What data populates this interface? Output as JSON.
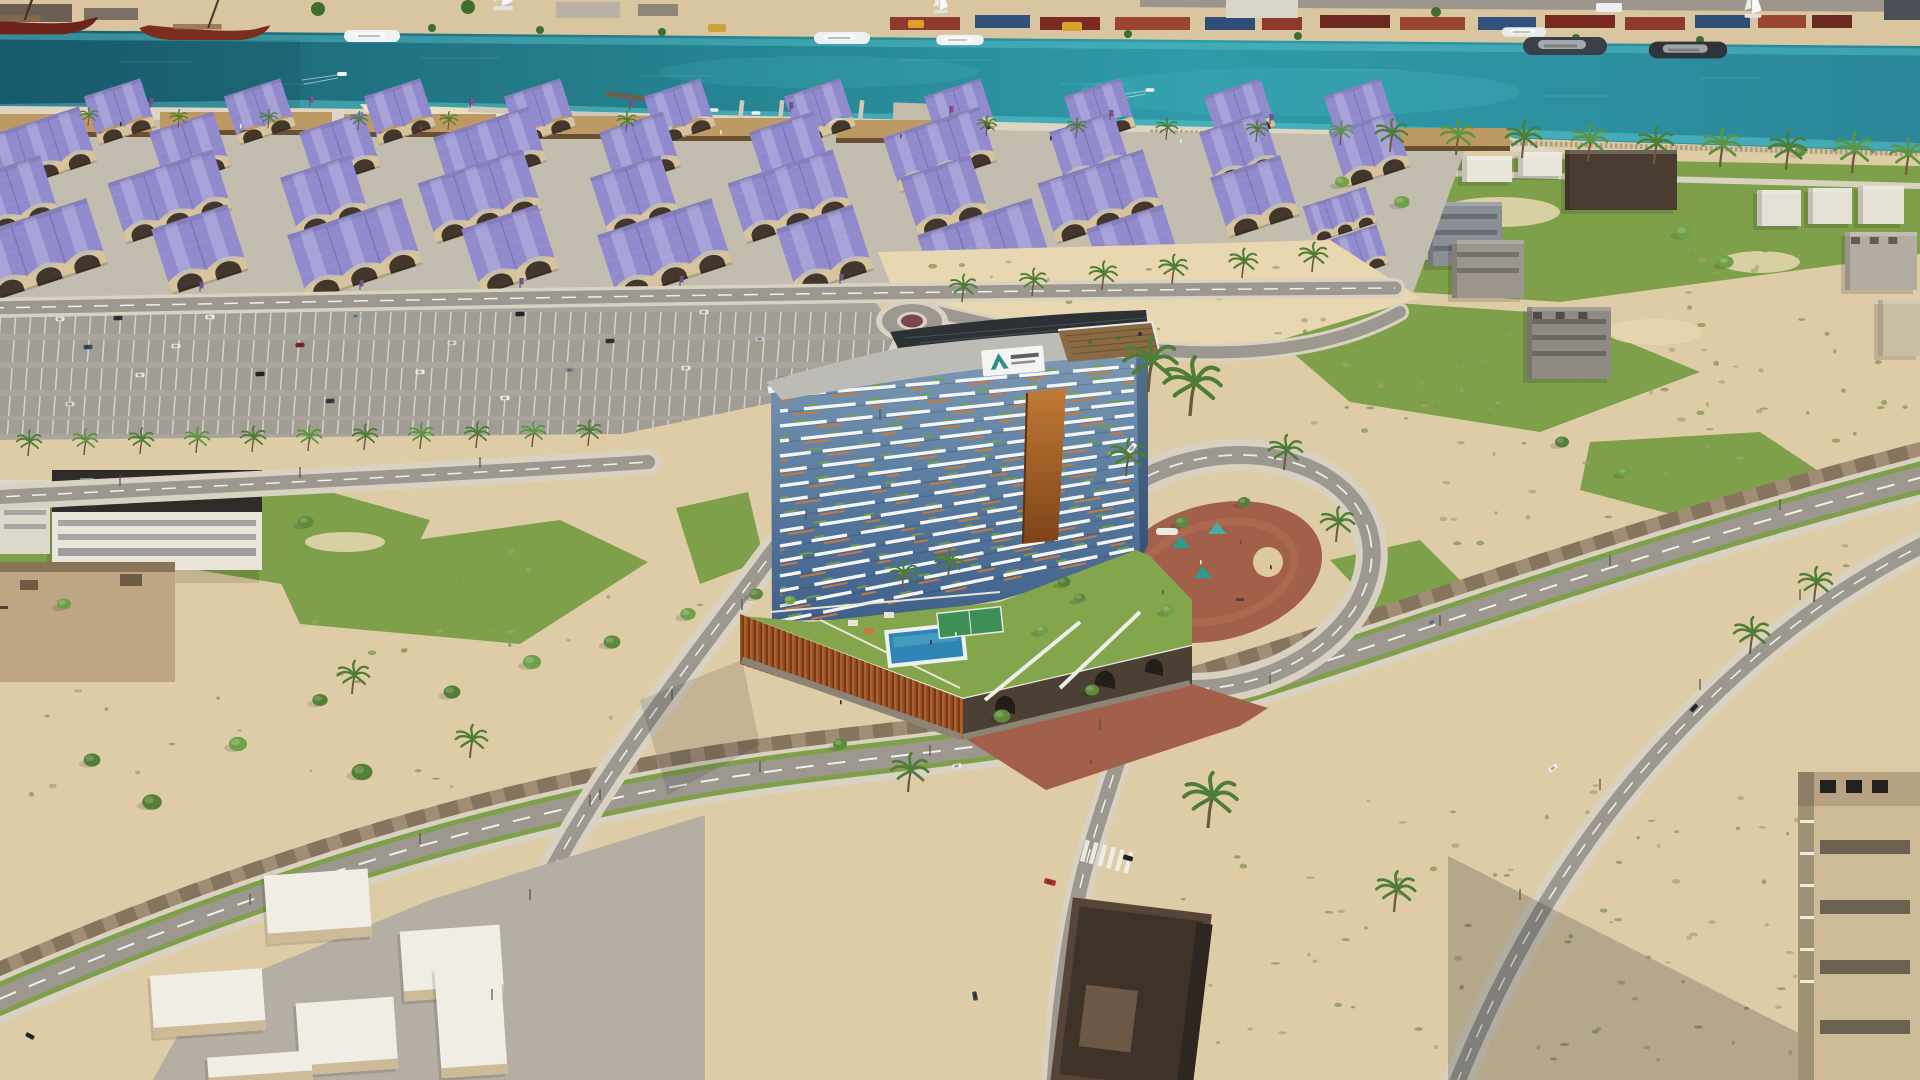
{
  "meta": {
    "title": "Aerial 3D rendering of a curved waterfront residential tower with podium pool deck, purple barrel-vault warehouse souk district, marina quay with yachts, parking lots, loop road plaza and desert infill lots",
    "image_type": "architectural visualization photograph (no UI elements)",
    "resolution": "1920x1080"
  },
  "palette": {
    "sand": "#decca6",
    "sand_light": "#e8d7b1",
    "quay": "#d9c6a0",
    "prom": "#ddd5c2",
    "lane": "#c3bdb0",
    "water_deep": "#1a5f70",
    "water_mid": "#27828f",
    "water_bright": "#2f9aa8",
    "water_shallow": "#5ec9cf",
    "grass": "#7fa04b",
    "deck_lawn": "#83a54c",
    "parking": "#a9a59d",
    "road": "#9c9890",
    "sidewalk": "#d9d2c2",
    "paver": "#a18c76",
    "brick": "#a2604a",
    "whroof": "#918bcd",
    "whwall": "#d8c49c",
    "wharch": "#43362c",
    "canopy": "#bd9a64",
    "stone": "#8c8476",
    "pool": "#2f86b5",
    "court": "#3d8f55",
    "podium_orange": "#b05e2c",
    "podium_orange_dark": "#7a3c1c",
    "podium_face_dark": "#4c4034",
    "glass_top": "#7d9ab5",
    "glass_mid": "#5d7fa2",
    "glass_bottom": "#3f608a",
    "balcony_white": "#f4f5f6",
    "accent_orange": "#c9793a",
    "plant_green": "#74a043",
    "roof_gray": "#bdbbb6",
    "pv_dark": "#2c3136",
    "pergola": "#8a6a44",
    "logo_teal": "#2a8f86",
    "tree": "#5d8a3c",
    "palm": "#4e7d35",
    "boat_red": "#6e241a",
    "yacht_dark": "#3a4047",
    "shadow": "rgba(20,25,30,0.22)"
  },
  "sign": {
    "shape": "white fascia billboard on tower crown",
    "mark": "teal triangular A emblem",
    "text": "dark wordmark, illegible at this resolution",
    "mark_color": "#2a8f86"
  },
  "tower": {
    "floors": 16,
    "x_left": 780,
    "x_right": 1134,
    "y_first_left": 396,
    "step_left": 15.0,
    "y_first_right": 366,
    "step_right": 12.2,
    "white_dashes": [
      "46 12 58 10 34 16 52 12 40 14",
      "30 16 52 10 62 12 36 14 48 10",
      "56 10 36 14 44 16 58 10 30 12",
      "40 12 62 10 30 18 54 10 44 12"
    ],
    "offsets": [
      0,
      22,
      9,
      31,
      15,
      3,
      27,
      12,
      20,
      6,
      34,
      17,
      25,
      11,
      29,
      8
    ],
    "orange_dash": "18 40 26 52 14 44 22 38",
    "green_dash": "8 46 14 38 10 52 12 42"
  },
  "warehouses": {
    "rows": [
      {
        "y": 112,
        "s": 0.74,
        "n2": true,
        "xs": [
          120,
          260,
          400,
          540,
          680,
          820,
          960,
          1100,
          1240,
          1360
        ]
      },
      {
        "y": 150,
        "s": 0.84,
        "xs": [
          40,
          190,
          340,
          490,
          640,
          790,
          940,
          1090,
          1240,
          1370
        ],
        "ns": [
          3,
          2,
          2,
          3,
          2,
          2,
          3,
          2,
          2,
          2
        ]
      },
      {
        "y": 197,
        "s": 0.92,
        "xs": [
          15,
          170,
          325,
          480,
          635,
          790,
          945,
          1100,
          1255
        ],
        "ns": [
          2,
          3,
          2,
          3,
          2,
          3,
          2,
          3,
          2
        ]
      },
      {
        "y": 250,
        "s": 1.0,
        "xs": [
          40,
          200,
          355,
          510,
          665,
          825,
          985,
          1135
        ],
        "ns": [
          3,
          2,
          3,
          2,
          3,
          2,
          3,
          2
        ]
      }
    ],
    "extras": [
      {
        "x": 1340,
        "y": 215,
        "s": 0.55,
        "n": 3
      },
      {
        "x": 1360,
        "y": 252,
        "s": 0.6,
        "n": 2
      }
    ]
  },
  "canopies": [
    [
      0,
      114,
      152
    ],
    [
      160,
      112,
      172
    ],
    [
      344,
      114,
      152
    ],
    [
      506,
      116,
      158
    ],
    [
      672,
      118,
      148
    ],
    [
      836,
      120,
      132
    ],
    [
      1392,
      128,
      118
    ]
  ],
  "containers": [
    [
      890,
      70,
      "#8f3a2c"
    ],
    [
      975,
      55,
      "#31517c"
    ],
    [
      1040,
      60,
      "#7a2a22"
    ],
    [
      1115,
      75,
      "#9a4532"
    ],
    [
      1205,
      50,
      "#2e4e78"
    ],
    [
      1262,
      40,
      "#8f3a2c"
    ],
    [
      1320,
      70,
      "#6b2a20"
    ],
    [
      1400,
      65,
      "#9a4532"
    ],
    [
      1478,
      58,
      "#31517c"
    ],
    [
      1545,
      70,
      "#7a2a22"
    ],
    [
      1625,
      60,
      "#8f3a2c"
    ],
    [
      1695,
      55,
      "#2e4e78"
    ],
    [
      1758,
      48,
      "#9a4532"
    ],
    [
      1812,
      40,
      "#6b2a20"
    ]
  ],
  "quay_buildings": [
    [
      0,
      4,
      72,
      18,
      "#6b5f54"
    ],
    [
      84,
      8,
      54,
      12,
      "#7d7166"
    ],
    [
      556,
      2,
      64,
      16,
      "#b9b2a4"
    ],
    [
      638,
      4,
      40,
      12,
      "#8f8776"
    ],
    [
      1226,
      0,
      72,
      18,
      "#d9d5c9"
    ],
    [
      1884,
      0,
      36,
      20,
      "#4a4f55"
    ]
  ],
  "trucks": [
    [
      1062,
      22,
      20,
      9,
      "#d9a22a"
    ],
    [
      708,
      24,
      18,
      8,
      "#caa23a"
    ],
    [
      908,
      20,
      16,
      8,
      "#d9a22a"
    ],
    [
      1596,
      3,
      26,
      9,
      "#eceef0"
    ]
  ],
  "quay_trees": [
    [
      150,
      30,
      4
    ],
    [
      318,
      9,
      7
    ],
    [
      468,
      7,
      7
    ],
    [
      432,
      28,
      4
    ],
    [
      540,
      30,
      4
    ],
    [
      662,
      32,
      4
    ],
    [
      1128,
      34,
      4
    ],
    [
      1298,
      36,
      4
    ],
    [
      1436,
      12,
      5
    ],
    [
      1576,
      38,
      4
    ],
    [
      1700,
      40,
      4
    ]
  ],
  "boats": [
    {
      "t": "dhow",
      "x": 15,
      "y": 20,
      "s": 1.6,
      "c": "#6e241a"
    },
    {
      "t": "dhow",
      "x": 200,
      "y": 28,
      "s": 1.35,
      "c": "#7c2e1e"
    },
    {
      "t": "yacht",
      "x": 372,
      "y": 36,
      "s": 1.0,
      "c": "#f1f2f3"
    },
    {
      "t": "yacht",
      "x": 842,
      "y": 38,
      "s": 1.0,
      "c": "#eef0f1"
    },
    {
      "t": "yacht",
      "x": 960,
      "y": 40,
      "s": 0.85,
      "c": "#f1f2f3"
    },
    {
      "t": "yacht",
      "x": 1524,
      "y": 32,
      "s": 0.8,
      "c": "#e8eaec"
    },
    {
      "t": "yacht",
      "x": 1565,
      "y": 46,
      "s": 1.5,
      "c": "#3a4047"
    },
    {
      "t": "yacht",
      "x": 1688,
      "y": 50,
      "s": 1.4,
      "c": "#2e343a"
    },
    {
      "t": "sail",
      "x": 502,
      "y": 6,
      "s": 1.1
    },
    {
      "t": "sail",
      "x": 940,
      "y": 10,
      "s": 0.8
    },
    {
      "t": "sail",
      "x": 1752,
      "y": 14,
      "s": 0.95
    },
    {
      "t": "skiff",
      "x": 342,
      "y": 74,
      "s": 1.0
    },
    {
      "t": "skiff",
      "x": 1150,
      "y": 90,
      "s": 0.9
    },
    {
      "t": "skiff",
      "x": 698,
      "y": 104,
      "s": 1.4
    },
    {
      "t": "skiff",
      "x": 714,
      "y": 110,
      "s": 0.9
    },
    {
      "t": "skiff",
      "x": 756,
      "y": 113,
      "s": 0.9
    },
    {
      "t": "skiff",
      "x": 800,
      "y": 111,
      "s": 0.9
    },
    {
      "t": "skiff",
      "x": 905,
      "y": 117,
      "s": 0.9
    },
    {
      "t": "skiff",
      "x": 933,
      "y": 119,
      "s": 0.9
    }
  ],
  "wave_lines": [
    [
      120,
      62,
      70
    ],
    [
      260,
      84,
      60
    ],
    [
      420,
      58,
      80
    ],
    [
      640,
      76,
      70
    ],
    [
      900,
      60,
      90
    ],
    [
      1060,
      84,
      70
    ],
    [
      1320,
      70,
      80
    ],
    [
      1540,
      96,
      70
    ],
    [
      1700,
      78,
      60
    ],
    [
      380,
      98,
      50
    ]
  ],
  "buildings_right": [
    {
      "x": 1300,
      "y": 142,
      "w": 46,
      "h": 56,
      "c": "#c4ad89",
      "ac": true
    },
    {
      "x": 1565,
      "y": 150,
      "w": 112,
      "h": 60,
      "c": "#4a3c30"
    },
    {
      "x": 1462,
      "y": 156,
      "w": 50,
      "h": 26,
      "c": "#e9e5db"
    },
    {
      "x": 1518,
      "y": 152,
      "w": 44,
      "h": 24,
      "c": "#e9e5db"
    },
    {
      "x": 1428,
      "y": 202,
      "w": 74,
      "h": 64,
      "c": "#8a8f96",
      "win": true
    },
    {
      "x": 1452,
      "y": 240,
      "w": 72,
      "h": 58,
      "c": "#9b958b",
      "win": true
    },
    {
      "x": 1527,
      "y": 307,
      "w": 84,
      "h": 72,
      "c": "#8f8a82",
      "ac": true,
      "win": true
    },
    {
      "x": 1757,
      "y": 190,
      "w": 44,
      "h": 36,
      "c": "#e4e0d6"
    },
    {
      "x": 1808,
      "y": 188,
      "w": 44,
      "h": 36,
      "c": "#e4e0d6"
    },
    {
      "x": 1858,
      "y": 186,
      "w": 46,
      "h": 38,
      "c": "#e4e0d6"
    },
    {
      "x": 1845,
      "y": 232,
      "w": 72,
      "h": 58,
      "c": "#b3aca0",
      "ac": true
    },
    {
      "x": 1878,
      "y": 300,
      "w": 42,
      "h": 56,
      "c": "#c9bda4"
    },
    {
      "x": 1245,
      "y": 205,
      "w": 60,
      "h": 26,
      "c": "#b9a887"
    },
    {
      "x": 1306,
      "y": 238,
      "w": 86,
      "h": 58,
      "c": "#c9b28e",
      "ac": true
    }
  ],
  "villas": [
    [
      266,
      872,
      104,
      68
    ],
    [
      152,
      972,
      112,
      62
    ],
    [
      298,
      1000,
      98,
      72
    ],
    [
      402,
      928,
      100,
      70
    ],
    [
      208,
      1054,
      104,
      30
    ],
    [
      438,
      966,
      66,
      110
    ]
  ],
  "parking_cars": [
    [
      60,
      319,
      "#e8e8e8"
    ],
    [
      118,
      318,
      "#2e3338"
    ],
    [
      210,
      317,
      "#f2f2f2"
    ],
    [
      356,
      316,
      "#9aa0a6"
    ],
    [
      520,
      314,
      "#24282c"
    ],
    [
      704,
      312,
      "#e8e8e8"
    ],
    [
      88,
      347,
      "#34506e"
    ],
    [
      176,
      346,
      "#e8e8e8"
    ],
    [
      300,
      345,
      "#7d2c24"
    ],
    [
      452,
      343,
      "#d9dadc"
    ],
    [
      610,
      341,
      "#2e3338"
    ],
    [
      760,
      339,
      "#c2c6ca"
    ],
    [
      140,
      375,
      "#e8e8e8"
    ],
    [
      260,
      374,
      "#1f2428"
    ],
    [
      420,
      372,
      "#eceff1"
    ],
    [
      570,
      370,
      "#8a9096"
    ],
    [
      686,
      368,
      "#e8e8e8"
    ],
    [
      70,
      404,
      "#d8d8d8"
    ],
    [
      330,
      401,
      "#3a4046"
    ],
    [
      505,
      398,
      "#efefef"
    ]
  ],
  "road_vehicles": [
    [
      30,
      1036,
      28,
      "#23282c",
      1
    ],
    [
      957,
      766,
      -10,
      "#ebebeb",
      1
    ],
    [
      1128,
      858,
      16,
      "#1f2428",
      1.1
    ],
    [
      1050,
      882,
      16,
      "#b03a30",
      1.3
    ],
    [
      975,
      996,
      80,
      "#3a4046",
      1
    ],
    [
      1553,
      768,
      -38,
      "#f4f4f4",
      1
    ],
    [
      1432,
      622,
      -32,
      "#8a9096",
      1
    ],
    [
      1694,
      708,
      -46,
      "#2a2f34",
      1
    ],
    [
      1132,
      448,
      -50,
      "#f2f2f0",
      1.2
    ]
  ],
  "trees": [
    [
      92,
      760,
      1.2
    ],
    [
      152,
      802,
      1.4
    ],
    [
      238,
      744,
      1.3
    ],
    [
      320,
      700,
      1.1
    ],
    [
      362,
      772,
      1.5
    ],
    [
      452,
      692,
      1.2
    ],
    [
      532,
      662,
      1.3
    ],
    [
      612,
      642,
      1.2
    ],
    [
      688,
      614,
      1.1
    ],
    [
      756,
      594,
      1.0
    ],
    [
      840,
      744,
      1.0
    ],
    [
      1002,
      716,
      1.2
    ],
    [
      1092,
      690,
      1.0
    ],
    [
      1042,
      630,
      0.9
    ],
    [
      1064,
      582,
      0.9
    ],
    [
      1182,
      522,
      1.0
    ],
    [
      1244,
      502,
      0.9
    ],
    [
      1342,
      182,
      1.0
    ],
    [
      1402,
      202,
      1.1
    ],
    [
      1562,
      442,
      1.0
    ],
    [
      1624,
      472,
      0.9
    ],
    [
      1684,
      232,
      1.2
    ],
    [
      1726,
      262,
      1.1
    ],
    [
      1800,
      152,
      0.8
    ],
    [
      306,
      522,
      1.1
    ],
    [
      64,
      604,
      1.0
    ],
    [
      1168,
      610,
      0.9
    ],
    [
      790,
      600,
      0.8
    ],
    [
      1080,
      598,
      0.8
    ]
  ],
  "palms": [
    [
      88,
      126,
      0.5
    ],
    [
      178,
      128,
      0.5
    ],
    [
      268,
      128,
      0.5
    ],
    [
      358,
      130,
      0.5
    ],
    [
      448,
      130,
      0.5
    ],
    [
      626,
      132,
      0.55
    ],
    [
      986,
      136,
      0.55
    ],
    [
      1076,
      138,
      0.55
    ],
    [
      1166,
      140,
      0.6
    ],
    [
      1256,
      142,
      0.6
    ],
    [
      1340,
      145,
      0.65
    ],
    [
      1390,
      152,
      0.9
    ],
    [
      1456,
      155,
      0.95
    ],
    [
      1522,
      158,
      1.0
    ],
    [
      1588,
      161,
      1.0
    ],
    [
      1654,
      164,
      1.0
    ],
    [
      1720,
      167,
      1.05
    ],
    [
      1786,
      170,
      1.05
    ],
    [
      1852,
      173,
      1.1
    ],
    [
      1906,
      175,
      1.0
    ],
    [
      28,
      456,
      0.7
    ],
    [
      84,
      455,
      0.7
    ],
    [
      140,
      454,
      0.7
    ],
    [
      196,
      453,
      0.7
    ],
    [
      252,
      452,
      0.7
    ],
    [
      308,
      451,
      0.7
    ],
    [
      364,
      450,
      0.7
    ],
    [
      420,
      449,
      0.7
    ],
    [
      476,
      448,
      0.7
    ],
    [
      532,
      447,
      0.7
    ],
    [
      588,
      446,
      0.7
    ],
    [
      962,
      302,
      0.75
    ],
    [
      1032,
      296,
      0.75
    ],
    [
      1102,
      290,
      0.78
    ],
    [
      1172,
      284,
      0.8
    ],
    [
      1242,
      278,
      0.8
    ],
    [
      1312,
      272,
      0.8
    ],
    [
      1148,
      392,
      1.5
    ],
    [
      1190,
      416,
      1.6
    ],
    [
      902,
      590,
      0.8
    ],
    [
      948,
      578,
      0.8
    ],
    [
      1126,
      476,
      1.0
    ],
    [
      1284,
      470,
      0.95
    ],
    [
      1336,
      542,
      0.95
    ],
    [
      908,
      792,
      1.05
    ],
    [
      1208,
      828,
      1.5
    ],
    [
      1394,
      912,
      1.1
    ],
    [
      1750,
      654,
      1.0
    ],
    [
      1814,
      602,
      0.95
    ],
    [
      352,
      694,
      0.9
    ],
    [
      470,
      758,
      0.9
    ]
  ],
  "scrub_regions": [
    [
      890,
      255,
      470,
      80,
      28
    ],
    [
      1640,
      240,
      270,
      220,
      36
    ],
    [
      1420,
      430,
      480,
      160,
      30
    ],
    [
      1150,
      780,
      560,
      290,
      55
    ],
    [
      30,
      545,
      680,
      250,
      40
    ],
    [
      1460,
      780,
      440,
      280,
      45
    ],
    [
      1310,
      330,
      280,
      120,
      24
    ]
  ],
  "people": [
    [
      120,
      122
    ],
    [
      240,
      124
    ],
    [
      420,
      126
    ],
    [
      560,
      128
    ],
    [
      720,
      130
    ],
    [
      900,
      134
    ],
    [
      1050,
      136
    ],
    [
      1180,
      139
    ],
    [
      1240,
      540
    ],
    [
      1270,
      565
    ],
    [
      1200,
      560
    ],
    [
      1162,
      590
    ],
    [
      930,
      640
    ],
    [
      955,
      632
    ],
    [
      1090,
      760
    ],
    [
      840,
      700
    ]
  ],
  "banners": [
    [
      150,
      108
    ],
    [
      310,
      106
    ],
    [
      470,
      108
    ],
    [
      630,
      110
    ],
    [
      790,
      112
    ],
    [
      950,
      116
    ],
    [
      1110,
      120
    ],
    [
      1270,
      124
    ],
    [
      200,
      292
    ],
    [
      360,
      290
    ],
    [
      520,
      288
    ],
    [
      680,
      286
    ],
    [
      840,
      284
    ]
  ],
  "posts": [
    [
      250,
      905
    ],
    [
      420,
      844
    ],
    [
      590,
      806
    ],
    [
      760,
      772
    ],
    [
      930,
      756
    ],
    [
      1100,
      730
    ],
    [
      1270,
      684
    ],
    [
      1440,
      626
    ],
    [
      1610,
      566
    ],
    [
      1780,
      510
    ],
    [
      880,
      420
    ],
    [
      806,
      520
    ],
    [
      742,
      610
    ],
    [
      672,
      700
    ],
    [
      600,
      800
    ],
    [
      530,
      900
    ],
    [
      492,
      1000
    ],
    [
      1520,
      900
    ],
    [
      1600,
      790
    ],
    [
      1700,
      690
    ],
    [
      1800,
      600
    ],
    [
      120,
      486
    ],
    [
      300,
      478
    ],
    [
      480,
      468
    ]
  ],
  "piers": [
    700,
    740,
    780,
    820,
    860
  ]
}
